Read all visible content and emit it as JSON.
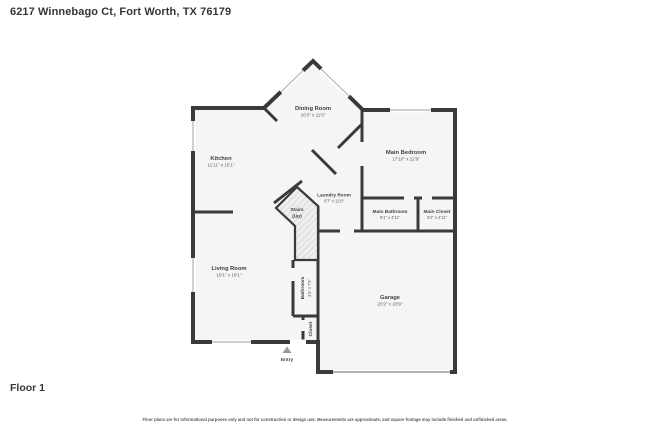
{
  "header": {
    "address": "6217 Winnebago Ct, Fort Worth, TX 76179"
  },
  "floorplan": {
    "rooms": {
      "dining": {
        "name": "Dining Room",
        "dims": "10'3\" x 11'5\""
      },
      "kitchen": {
        "name": "Kitchen",
        "dims": "11'11\" x 15'1\""
      },
      "main_bedroom": {
        "name": "Main Bedroom",
        "dims": "17'10\" x 12'9\""
      },
      "laundry": {
        "name": "Laundry Room",
        "dims": "9'7\" x 11'8\""
      },
      "stairs": {
        "name": "Stairs",
        "sub": "(Up)"
      },
      "main_bathroom": {
        "name": "Main Bathroom",
        "dims": "8'1\" x 4'11\""
      },
      "main_closet": {
        "name": "Main Closet",
        "dims": "5'2\" x 4'11\""
      },
      "living": {
        "name": "Living Room",
        "dims": "16'1\" x 19'1\""
      },
      "bathroom": {
        "name": "Bathroom",
        "dims": "3'5\" x 7'5\""
      },
      "closet": {
        "name": "Closet"
      },
      "garage": {
        "name": "Garage",
        "dims": "20'2\" x 20'9\""
      },
      "entry": {
        "name": "Entry"
      }
    },
    "colors": {
      "walls": "#3a3a3a",
      "room_fill": "#f5f5f5",
      "stairs_hatch": "#d6d6d6",
      "window": "#b2b2b2"
    }
  },
  "footer": {
    "floor_label": "Floor 1",
    "disclaimer": "Floor plans are for informational purposes only and not for construction or design use. Measurements are approximate, and square footage may include finished and unfinished areas."
  }
}
